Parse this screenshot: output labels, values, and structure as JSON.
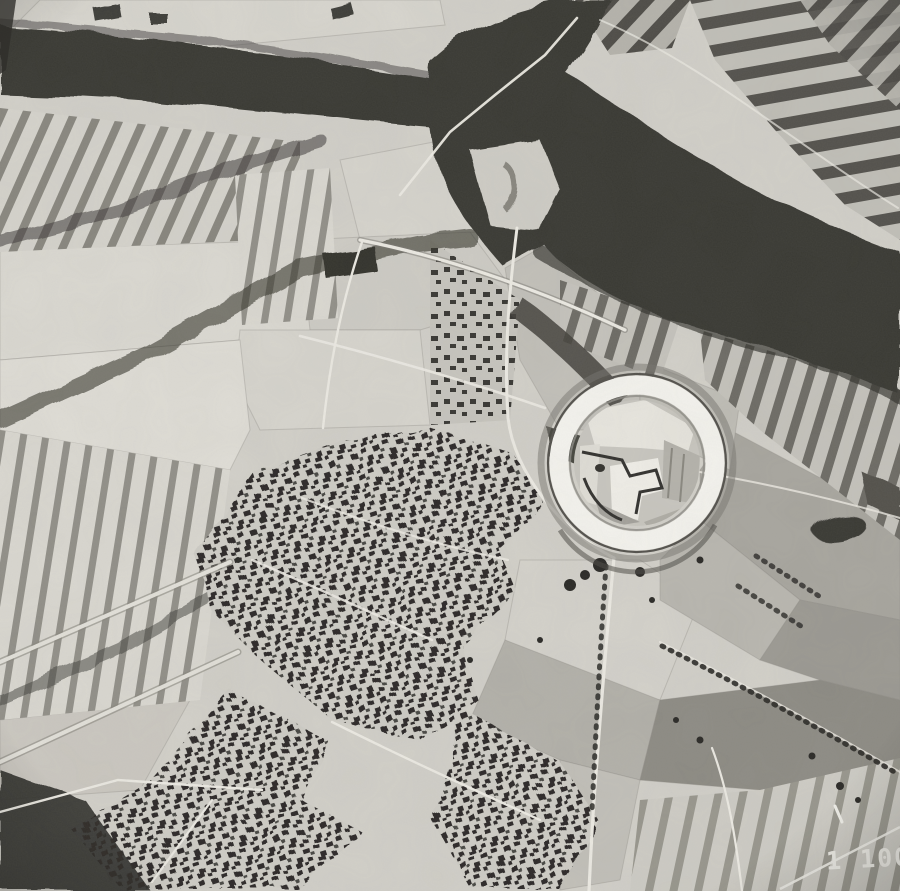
{
  "photo": {
    "scale_label": "1 100"
  },
  "annotation": {
    "highlight_shape": "circle",
    "highlight_name": "ringfort-highlight"
  },
  "palette": {
    "base": "#d3d1ca",
    "field_light": "#dfded8",
    "field_mid": "#b0aea6",
    "field_dark": "#8d8b84",
    "water_dark": "#3b3a36",
    "ink_dark": "#2d2c29",
    "highlight_white": "#f5f4ef",
    "text_white": "#efeee8"
  }
}
